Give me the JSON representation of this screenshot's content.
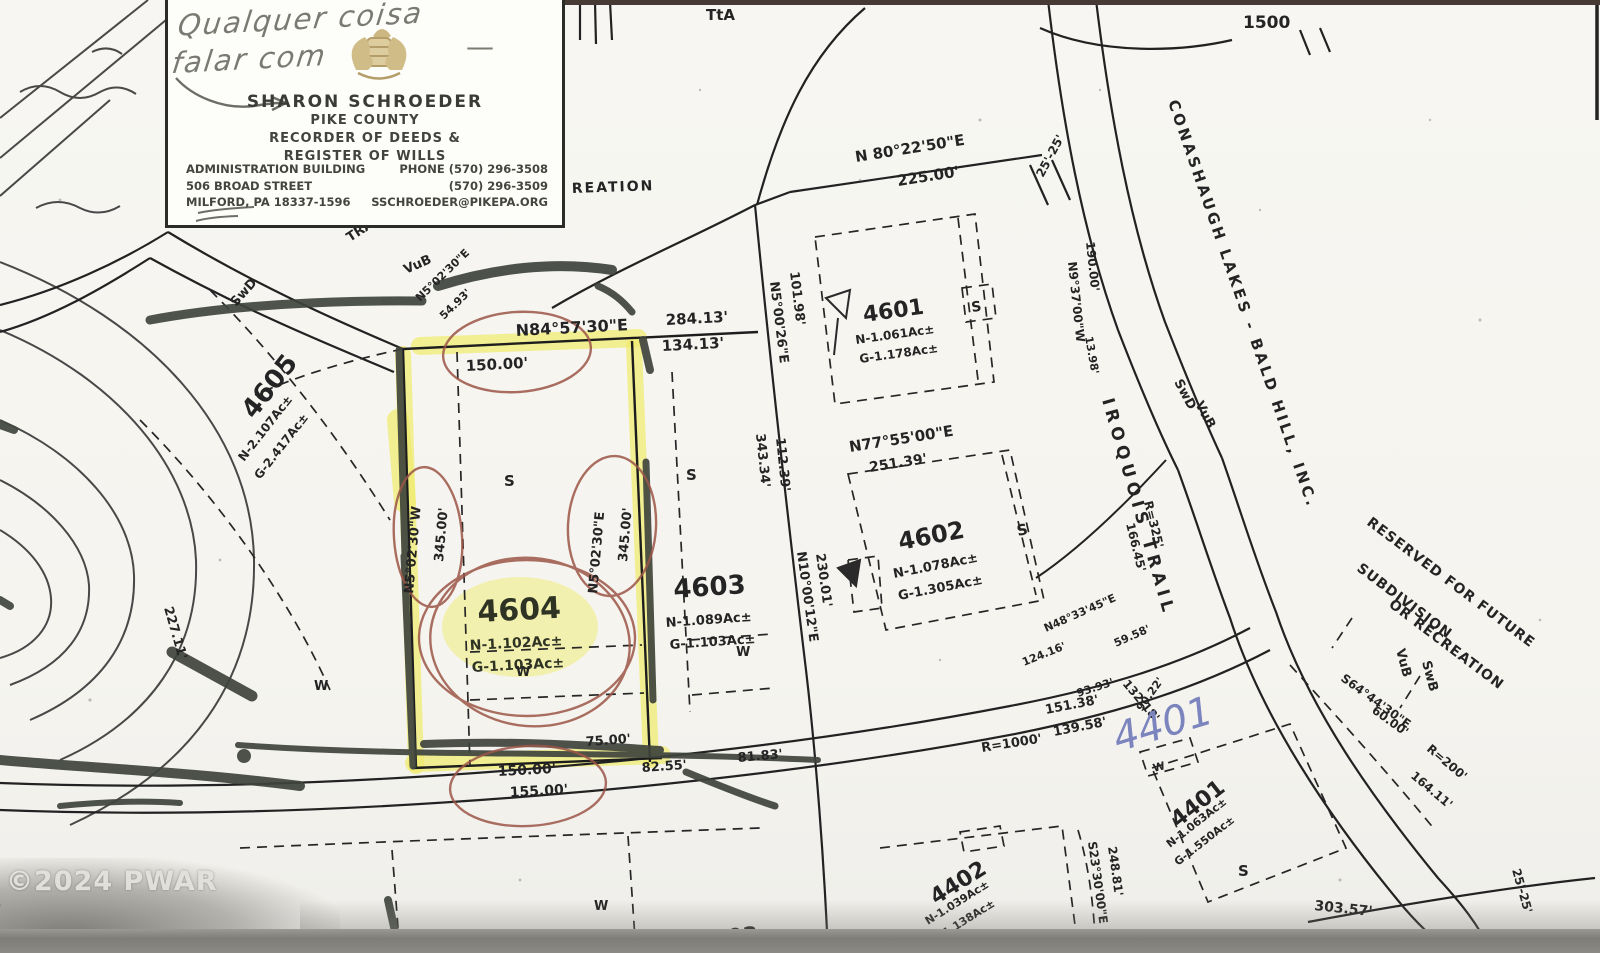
{
  "colors": {
    "highlighter_yellow": "#f0ec6e",
    "dark_marker": "#3f443d",
    "red_pen": "#9c5648",
    "blue_pen": "#7b84bd",
    "crest_gold": "#b2975a",
    "scan_band_gray": "#8b8a85"
  },
  "watermark": "©2024 PWAR",
  "business_card": {
    "handwritten_line1": "Qualquer coisa",
    "handwritten_dash": "—",
    "handwritten_line2": "falar com",
    "name": "SHARON SCHROEDER",
    "county": "PIKE COUNTY",
    "role1": "RECORDER OF DEEDS &",
    "role2": "REGISTER OF WILLS",
    "addr1": "ADMINISTRATION BUILDING",
    "addr2": "506 BROAD STREET",
    "addr3": "MILFORD, PA 18337-1596",
    "phone1": "PHONE (570) 296-3508",
    "phone2": "(570) 296-3509",
    "email": "SSCHROEDER@PIKEPA.ORG"
  },
  "map": {
    "lots": {
      "l4601": {
        "number": "4601",
        "net": "N-1.061Ac±",
        "gross": "G-1.178Ac±"
      },
      "l4602": {
        "number": "4602",
        "net": "N-1.078Ac±",
        "gross": "G-1.305Ac±"
      },
      "l4603": {
        "number": "4603",
        "net": "N-1.089Ac±",
        "gross": "G-1.103Ac±"
      },
      "l4604": {
        "number": "4604",
        "net": "N-1.102Ac±",
        "gross": "G-1.103Ac±"
      },
      "l4605": {
        "number": "4605",
        "net": "N-2.107Ac±",
        "gross": "G-2.417Ac±"
      },
      "l4401": {
        "number": "4401",
        "net": "N-1.063Ac±",
        "gross": "G-1.550Ac±"
      },
      "l4402": {
        "number": "4402",
        "net": "N-1.039Ac±",
        "gross": "G-1.138Ac±"
      },
      "l4403": {
        "number": "4403"
      }
    },
    "annotations": {
      "handwritten_lot": "4401"
    },
    "markers": {
      "septic": "S",
      "well": "W"
    },
    "labels": {
      "contour1500": "1500",
      "tta": "TtA",
      "reation": "REATION",
      "tra": "TRA",
      "vubL": "VuB",
      "swdL": "SwD",
      "n80": "N 80°22'50\"E",
      "d225": "225.00'",
      "rw25a": "25'-25'",
      "d101": "101.98'",
      "n5_0026": "N5°00'26\"E",
      "d343": "343.34'",
      "d112": "112.39'",
      "n84": "N84°57'30\"E",
      "d284": "284.13'",
      "d134": "134.13'",
      "d150t": "150.00'",
      "n5sm": "N5°02'30\"E",
      "d54": "54.93'",
      "n5L": "N5°02'30\"W",
      "d345L": "345.00'",
      "n5R": "N5°02'30\"E",
      "d345R": "345.00'",
      "n77": "N77°55'00\"E",
      "d251": "251.39'",
      "n10": "N10°00'12\"E",
      "d230": "230.01'",
      "n9": "N9°37'00\"W",
      "d190": "190.00'",
      "d13": "13.98'",
      "conashaugh": "CONASHAUGH LAKES - BALD HILL, INC.",
      "iroquois": "IROQUOIS TRAIL",
      "swdR": "SwD",
      "vubR": "VuB",
      "r325": "R=325'",
      "d166": "166.45'",
      "res1": "RESERVED FOR FUTURE",
      "res2": "SUBDIVISION",
      "res3": "OR RECREATION",
      "vubR2": "VuB",
      "swbR": "SwB",
      "s64": "S64°44'30\"E",
      "d60": "60.00'",
      "r200": "R=200'",
      "d164": "164.11'",
      "d303": "303.57'",
      "rw25b": "25'-25'",
      "s23": "S23°30'00\"E",
      "d248": "248.81'",
      "d227": "227.11'",
      "d132": "132.18'",
      "n48": "N48°33'45\"E",
      "d59": "59.58'",
      "d124": "124.16'",
      "d93": "93.93'",
      "d151": "151.38'",
      "d139": "139.58'",
      "d90": "90.22'",
      "r1000": "R=1000'",
      "d75": "75.00'",
      "d82": "82.55'",
      "d81": "81.83'",
      "d150b": "150.00'",
      "d155": "155.00'"
    }
  }
}
